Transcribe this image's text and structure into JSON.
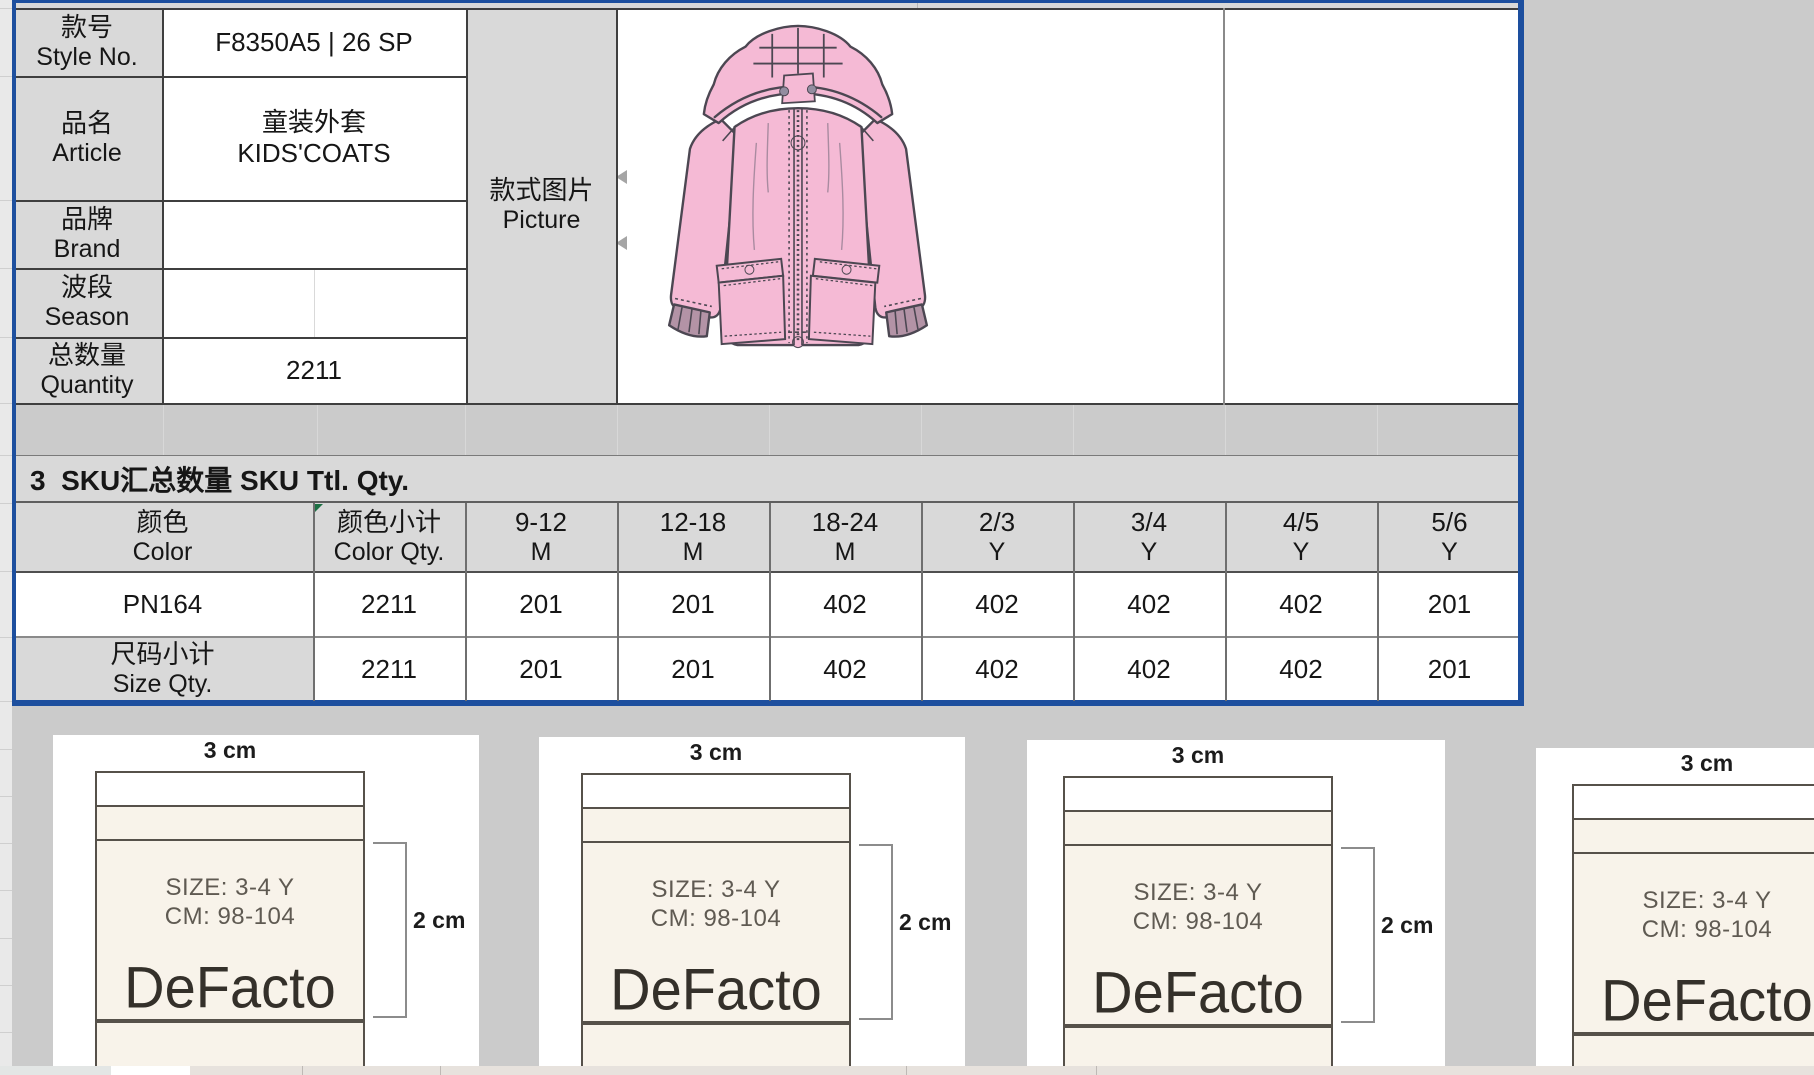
{
  "sheet": {
    "info_table": {
      "rows": [
        {
          "label_zh": "款号",
          "label_en": "Style No.",
          "value": "F8350A5 | 26 SP",
          "value2": ""
        },
        {
          "label_zh": "品名",
          "label_en": "Article",
          "value": "童装外套",
          "value2": "KIDS'COATS"
        },
        {
          "label_zh": "品牌",
          "label_en": "Brand",
          "value": "",
          "value2": ""
        },
        {
          "label_zh": "波段",
          "label_en": "Season",
          "value": "",
          "value2": ""
        },
        {
          "label_zh": "总数量",
          "label_en": "Quantity",
          "value": "2211",
          "value2": ""
        }
      ],
      "picture_label_zh": "款式图片",
      "picture_label_en": "Picture"
    },
    "sku_section": {
      "title": "3  SKU汇总数量 SKU Ttl. Qty.",
      "headers": [
        {
          "line1": "颜色",
          "line2": "Color"
        },
        {
          "line1": "颜色小计",
          "line2": "Color Qty."
        },
        {
          "line1": "9-12",
          "line2": "M"
        },
        {
          "line1": "12-18",
          "line2": "M"
        },
        {
          "line1": "18-24",
          "line2": "M"
        },
        {
          "line1": "2/3",
          "line2": "Y"
        },
        {
          "line1": "3/4",
          "line2": "Y"
        },
        {
          "line1": "4/5",
          "line2": "Y"
        },
        {
          "line1": "5/6",
          "line2": "Y"
        }
      ],
      "color_row": {
        "name": "PN164",
        "values": [
          "2211",
          "201",
          "201",
          "402",
          "402",
          "402",
          "402",
          "201"
        ]
      },
      "total_row": {
        "label_zh": "尺码小计",
        "label_en": "Size Qty.",
        "values": [
          "2211",
          "201",
          "201",
          "402",
          "402",
          "402",
          "402",
          "201"
        ]
      }
    },
    "care_labels": {
      "width_caption": "3 cm",
      "height_caption": "2 cm",
      "size_line": "SIZE: 3-4 Y",
      "cm_line": "CM: 98-104",
      "brand": "DeFacto"
    },
    "colors": {
      "selection_border": "#1d4f9e",
      "header_fill": "#d9d9d9",
      "outside_fill": "#cbcbcb",
      "label_cream": "#f8f3ea",
      "coat_pink": "#f5bad5",
      "marker_green": "#1e7145"
    }
  }
}
